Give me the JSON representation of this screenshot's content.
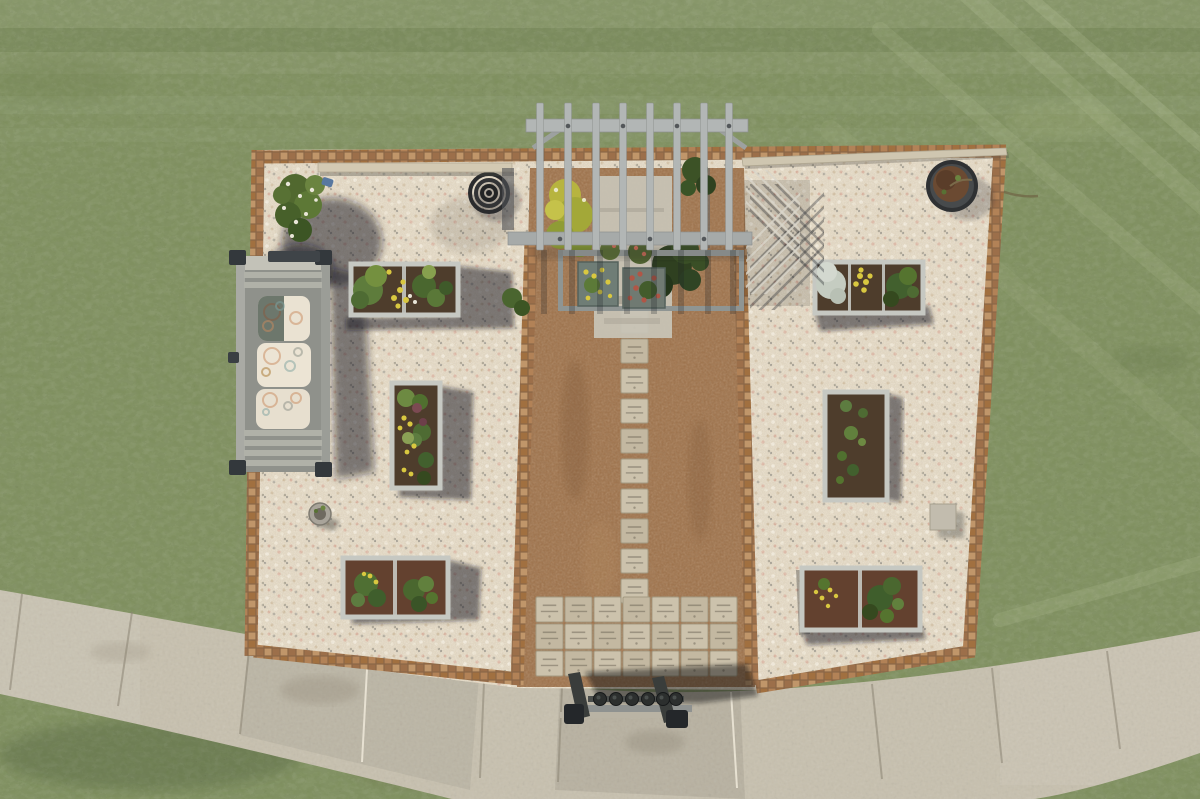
{
  "scene": {
    "title": "Aerial drone view of a community memorial garden",
    "description": "Top-down drone photo of a rectangular gravel community garden surrounded by lawn: a central brown mulch path lined with engraved memorial pavers, a weathered wooden pergola at the top, six raised planting beds, a cushioned wooden bench, a barrel planter, a coiled hose, a trellis, a small plant stand with pots, and a curved concrete sidewalk across the bottom",
    "palette": {
      "grass": "#7d8e5c",
      "grass_light": "#9aa76e",
      "grass_dark": "#667d4e",
      "gravel": "#e2d6bf",
      "mulch": "#9c7049",
      "brick": "#aa7c54",
      "paver": "#ccc2ac",
      "concrete": "#c7c0ae",
      "wood": "#b2b6b5",
      "wood_light": "#c6c8c2",
      "wood_dark": "#85898a",
      "cushion": "#eae2d2",
      "foliage": "#4e6b33",
      "foliage_dark": "#35491f",
      "foliage_light": "#87a04e",
      "flower_yellow": "#d9c840",
      "flower_red": "#b05646",
      "plant_silver": "#c5ccc1",
      "soil": "#4e3d2c",
      "soil_red": "#63412f",
      "shadow": "rgba(24,27,31,0.5)",
      "metal_dark": "#2c2f2e",
      "trellis": "#d9d6ca"
    }
  },
  "lawn": {
    "label": "surrounding lawn"
  },
  "garden": {
    "label": "gravel garden plot with brick border"
  },
  "pergola": {
    "label": "weathered wooden pergola",
    "slat_x": [
      540,
      568,
      596,
      623,
      650,
      677,
      704,
      729
    ],
    "slat_top": 103,
    "slat_len": 147
  },
  "path": {
    "label": "mulch path with engraved memorial pavers",
    "column_x": 621,
    "paver_w": 27,
    "paver_h": 24,
    "column_pavers": [
      309,
      339,
      369,
      399,
      429,
      459,
      489,
      519,
      549,
      579
    ],
    "grid": {
      "cols": [
        536,
        565,
        594,
        623,
        652,
        681,
        710
      ],
      "rows": [
        597,
        624,
        651
      ],
      "w": 27,
      "h": 25
    }
  },
  "sidewalk": {
    "label": "curved concrete sidewalk",
    "joints": [
      [
        22,
        594,
        10,
        690
      ],
      [
        132,
        612,
        118,
        706
      ],
      [
        250,
        641,
        240,
        734
      ],
      [
        367,
        669,
        362,
        762
      ],
      [
        484,
        682,
        480,
        778
      ],
      [
        562,
        687,
        558,
        782
      ],
      [
        731,
        692,
        737,
        788
      ],
      [
        872,
        684,
        882,
        779
      ],
      [
        992,
        668,
        1002,
        763
      ],
      [
        1107,
        651,
        1120,
        749
      ]
    ]
  },
  "bench": {
    "label": "wooden bench with patterned cushions",
    "cushion_count": 3
  },
  "beds": {
    "label": "raised planting beds",
    "count": 6
  },
  "planters": {
    "shrub": {
      "label": "flowering shrub in corner"
    },
    "hose": {
      "label": "coiled garden hose"
    },
    "barrel": {
      "label": "barrel planter"
    },
    "trellis": {
      "label": "lattice trellis"
    },
    "stand": {
      "label": "plant stand with small pots",
      "pot_xs": [
        600,
        616,
        632,
        648,
        663,
        676
      ]
    }
  }
}
